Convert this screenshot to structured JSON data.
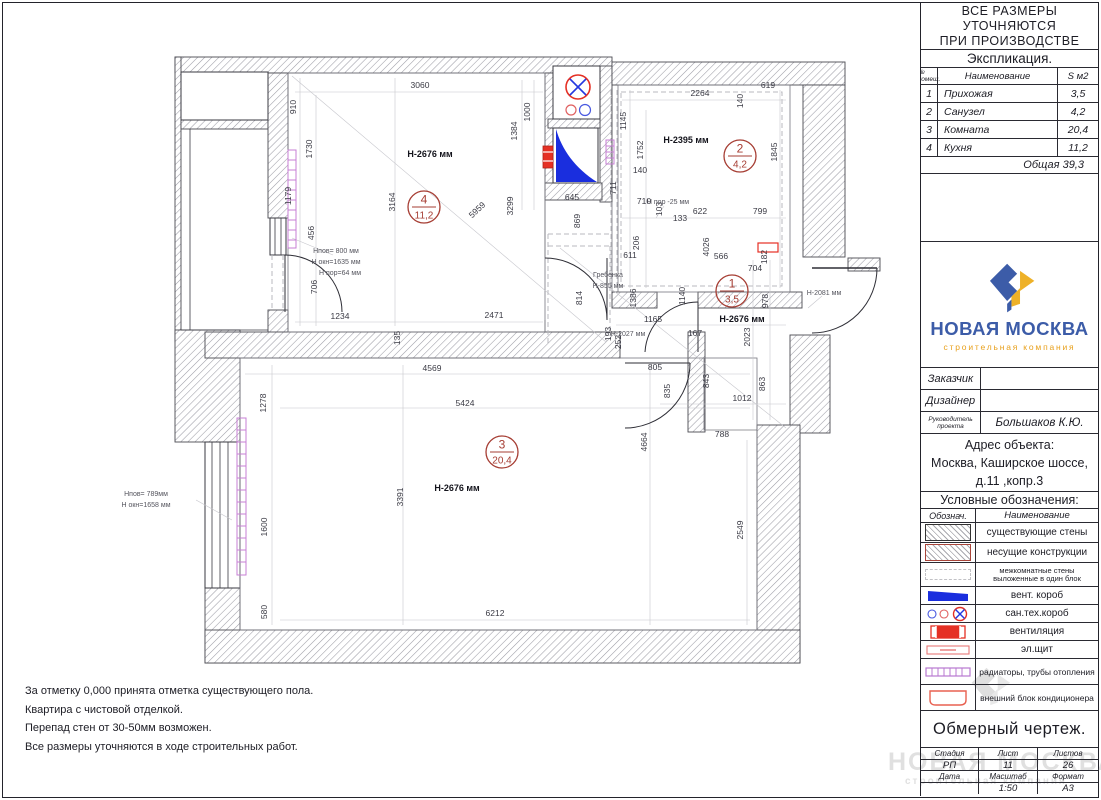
{
  "note": {
    "l1": "ВСЕ РАЗМЕРЫ УТОЧНЯЮТСЯ",
    "l2": "ПРИ ПРОИЗВОДСТВЕ РАБОТ.",
    "l3": "Размеры указаны в миллиметрах."
  },
  "expl": {
    "title": "Экспликация.",
    "h_num": "№ помещ.",
    "h_name": "Наименование",
    "h_area": "S м2",
    "rows": [
      {
        "num": "1",
        "name": "Прихожая",
        "area": "3,5"
      },
      {
        "num": "2",
        "name": "Санузел",
        "area": "4,2"
      },
      {
        "num": "3",
        "name": "Комната",
        "area": "20,4"
      },
      {
        "num": "4",
        "name": "Кухня",
        "area": "11,2"
      }
    ],
    "total": "Общая 39,3"
  },
  "logo": {
    "title": "НОВАЯ МОСКВА",
    "subtitle": "строительная компания"
  },
  "people": {
    "r1l": "Заказчик",
    "r1v": "",
    "r2l": "Дизайнер",
    "r2v": "",
    "r3l1": "Руководитель",
    "r3l2": "проекта",
    "r3v": "Большаков К.Ю."
  },
  "address": {
    "h": "Адрес объекта:",
    "l1": "Москва, Каширское шоссе,",
    "l2": "д.11 ,копр.3"
  },
  "legend": {
    "title": "Условные обозначения:",
    "h_sym": "Обознач.",
    "h_name": "Наименование",
    "items": [
      {
        "name": "существующие стены"
      },
      {
        "name": "несущие конструкции"
      },
      {
        "name": "межкомнатные стены выложенные в один блок"
      },
      {
        "name": "вент. короб"
      },
      {
        "name": "сан.тех.короб"
      },
      {
        "name": "вентиляция"
      },
      {
        "name": "эл.щит"
      },
      {
        "name": "радиаторы, трубы отопления"
      },
      {
        "name": "внешний блок кондиционера"
      }
    ]
  },
  "doc_title": "Обмерный чертеж.",
  "stamp": {
    "h_stage": "Стадия",
    "h_sheet": "Лист",
    "h_sheets": "Листов",
    "v_stage": "РП",
    "v_sheet": "11",
    "v_sheets": "26",
    "h_date": "Дата",
    "h_scale": "Масштаб",
    "h_format": "Формат",
    "v_date": "",
    "v_scale": "1:50",
    "v_format": "А3"
  },
  "notes": [
    "За отметку 0,000 принята отметка существующего пола.",
    "Квартира с чистовой отделкой.",
    "Перепад стен от 30-50мм возможен.",
    "Все размеры уточняются в ходе строительных работ."
  ],
  "watermark": {
    "text": "НОВАЯ МОСКВА",
    "sub": "строительная компания"
  },
  "colors": {
    "accent_blue": "#3c5ca8",
    "accent_yellow": "#e8a01c",
    "vent_blue": "#1a2ede",
    "vent_red": "#e53024",
    "radiator_pink": "#c77fd4",
    "room_mark": "#a63d33"
  },
  "plan": {
    "rooms": [
      {
        "num": "4",
        "area": "11,2",
        "cx": 424,
        "cy": 207
      },
      {
        "num": "2",
        "area": "4,2",
        "cx": 740,
        "cy": 156
      },
      {
        "num": "1",
        "area": "3,5",
        "cx": 732,
        "cy": 291
      },
      {
        "num": "3",
        "area": "20,4",
        "cx": 502,
        "cy": 452
      }
    ],
    "dims": [
      {
        "t": "3060",
        "x": 420,
        "y": 88
      },
      {
        "t": "910",
        "x": 296,
        "y": 107,
        "r": -90
      },
      {
        "t": "1730",
        "x": 312,
        "y": 149,
        "r": -90
      },
      {
        "t": "1179",
        "x": 291,
        "y": 196,
        "r": -90
      },
      {
        "t": "456",
        "x": 314,
        "y": 233,
        "r": -90
      },
      {
        "t": "706",
        "x": 317,
        "y": 287,
        "r": -90
      },
      {
        "t": "1234",
        "x": 340,
        "y": 319
      },
      {
        "t": "2471",
        "x": 494,
        "y": 318
      },
      {
        "t": "135",
        "x": 400,
        "y": 338,
        "r": -90
      },
      {
        "t": "3164",
        "x": 395,
        "y": 202,
        "r": -90
      },
      {
        "t": "5959",
        "x": 479,
        "y": 212,
        "r": -43
      },
      {
        "t": "3299",
        "x": 513,
        "y": 206,
        "r": -90
      },
      {
        "t": "1384",
        "x": 517,
        "y": 131,
        "r": -90
      },
      {
        "t": "1000",
        "x": 530,
        "y": 112,
        "r": -90
      },
      {
        "t": "645",
        "x": 572,
        "y": 200
      },
      {
        "t": "869",
        "x": 580,
        "y": 221,
        "r": -90
      },
      {
        "t": "814",
        "x": 582,
        "y": 298,
        "r": -90
      },
      {
        "t": "2264",
        "x": 700,
        "y": 96
      },
      {
        "t": "619",
        "x": 768,
        "y": 88
      },
      {
        "t": "140",
        "x": 743,
        "y": 101,
        "r": -90
      },
      {
        "t": "1145",
        "x": 626,
        "y": 121,
        "r": -90
      },
      {
        "t": "1752",
        "x": 643,
        "y": 150,
        "r": -90
      },
      {
        "t": "1845",
        "x": 777,
        "y": 152,
        "r": -90
      },
      {
        "t": "140",
        "x": 640,
        "y": 173
      },
      {
        "t": "711",
        "x": 616,
        "y": 188,
        "r": -90
      },
      {
        "t": "710",
        "x": 644,
        "y": 204
      },
      {
        "t": "103",
        "x": 662,
        "y": 209,
        "r": -90
      },
      {
        "t": "133",
        "x": 680,
        "y": 221
      },
      {
        "t": "622",
        "x": 700,
        "y": 214
      },
      {
        "t": "799",
        "x": 760,
        "y": 214
      },
      {
        "t": "206",
        "x": 639,
        "y": 243,
        "r": -90
      },
      {
        "t": "611",
        "x": 630,
        "y": 258
      },
      {
        "t": "566",
        "x": 721,
        "y": 259
      },
      {
        "t": "4026",
        "x": 709,
        "y": 247,
        "r": -90
      },
      {
        "t": "182",
        "x": 767,
        "y": 257,
        "r": -90
      },
      {
        "t": "704",
        "x": 755,
        "y": 271
      },
      {
        "t": "978",
        "x": 768,
        "y": 301,
        "r": -90
      },
      {
        "t": "2023",
        "x": 750,
        "y": 337,
        "r": -90
      },
      {
        "t": "1165",
        "x": 653,
        "y": 322
      },
      {
        "t": "167",
        "x": 695,
        "y": 336
      },
      {
        "t": "1386",
        "x": 636,
        "y": 298,
        "r": -90
      },
      {
        "t": "1140",
        "x": 685,
        "y": 296,
        "r": -90
      },
      {
        "t": "193",
        "x": 611,
        "y": 334,
        "r": -90
      },
      {
        "t": "252",
        "x": 621,
        "y": 342,
        "r": -90
      },
      {
        "t": "805",
        "x": 655,
        "y": 370
      },
      {
        "t": "835",
        "x": 670,
        "y": 391,
        "r": -90
      },
      {
        "t": "843",
        "x": 709,
        "y": 381,
        "r": -90
      },
      {
        "t": "863",
        "x": 765,
        "y": 384,
        "r": -90
      },
      {
        "t": "1012",
        "x": 742,
        "y": 401
      },
      {
        "t": "788",
        "x": 722,
        "y": 437
      },
      {
        "t": "4664",
        "x": 647,
        "y": 442,
        "r": -90
      },
      {
        "t": "2549",
        "x": 743,
        "y": 530,
        "r": -90
      },
      {
        "t": "4569",
        "x": 432,
        "y": 371
      },
      {
        "t": "5424",
        "x": 465,
        "y": 406
      },
      {
        "t": "6212",
        "x": 495,
        "y": 616
      },
      {
        "t": "3391",
        "x": 403,
        "y": 497,
        "r": -90
      },
      {
        "t": "1278",
        "x": 266,
        "y": 403,
        "r": -90
      },
      {
        "t": "1600",
        "x": 267,
        "y": 527,
        "r": -90
      },
      {
        "t": "580",
        "x": 267,
        "y": 612,
        "r": -90
      },
      {
        "t": "Н-2676 мм",
        "x": 430,
        "y": 157,
        "k": "h"
      },
      {
        "t": "Н-2395 мм",
        "x": 686,
        "y": 143,
        "k": "h"
      },
      {
        "t": "Н-2676 мм",
        "x": 742,
        "y": 322,
        "k": "h"
      },
      {
        "t": "Н-2676 мм",
        "x": 457,
        "y": 491,
        "k": "h"
      },
      {
        "t": "Hпов= 800 мм",
        "x": 336,
        "y": 253,
        "s": 1,
        "a": "start"
      },
      {
        "t": "Н окн=1635 мм",
        "x": 336,
        "y": 264,
        "s": 1,
        "a": "start"
      },
      {
        "t": "Н пор=64 мм",
        "x": 340,
        "y": 275,
        "s": 1,
        "a": "start"
      },
      {
        "t": "Hпов= 789мм",
        "x": 146,
        "y": 496,
        "s": 1,
        "a": "start"
      },
      {
        "t": "Н окн=1658 мм",
        "x": 146,
        "y": 507,
        "s": 1,
        "a": "start"
      },
      {
        "t": "Гребенка",
        "x": 608,
        "y": 277,
        "s": 1,
        "a": "start"
      },
      {
        "t": "Н-855 мм",
        "x": 608,
        "y": 288,
        "s": 1,
        "a": "start"
      },
      {
        "t": "Н пор -25 мм",
        "x": 668,
        "y": 204,
        "s": 1
      },
      {
        "t": "Н-2081 мм",
        "x": 824,
        "y": 295,
        "s": 1,
        "a": "start"
      },
      {
        "t": "Н-2027 мм",
        "x": 628,
        "y": 336,
        "s": 1
      }
    ]
  }
}
